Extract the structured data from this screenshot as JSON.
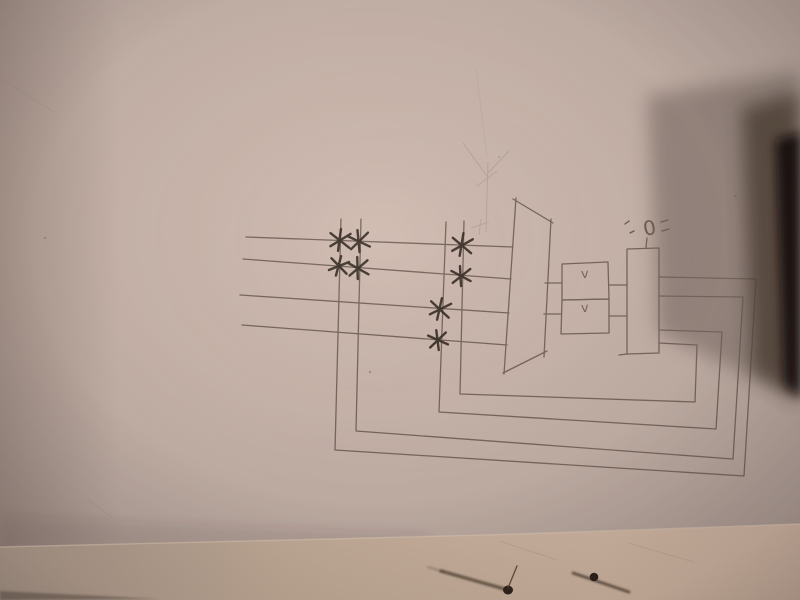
{
  "scene": {
    "description": "Photograph of a pencil-drawn schematic sketch on pinkish paper; a dark object casts a shadow over the top-right corner; the edge of a second sheet with two small ink marks runs along the bottom",
    "colors": {
      "paper": "#c6b2a8",
      "paper_edge_vignette": "#9c8d86",
      "bottom_sheet": "#c2aa99",
      "pencil_line": "#6a5b52",
      "crosspoint_mark": "#372d25",
      "object_shadow": "#6f625c",
      "object_core": "#140d0a"
    }
  },
  "diagram": {
    "input_lines": 4,
    "column_lines": 4,
    "crosspoints": 8,
    "feedback_loops": 4,
    "selector_block": "trapezoid",
    "gate_boxes": [
      {
        "label": "v"
      },
      {
        "label": "v"
      }
    ],
    "source_label": "0"
  }
}
